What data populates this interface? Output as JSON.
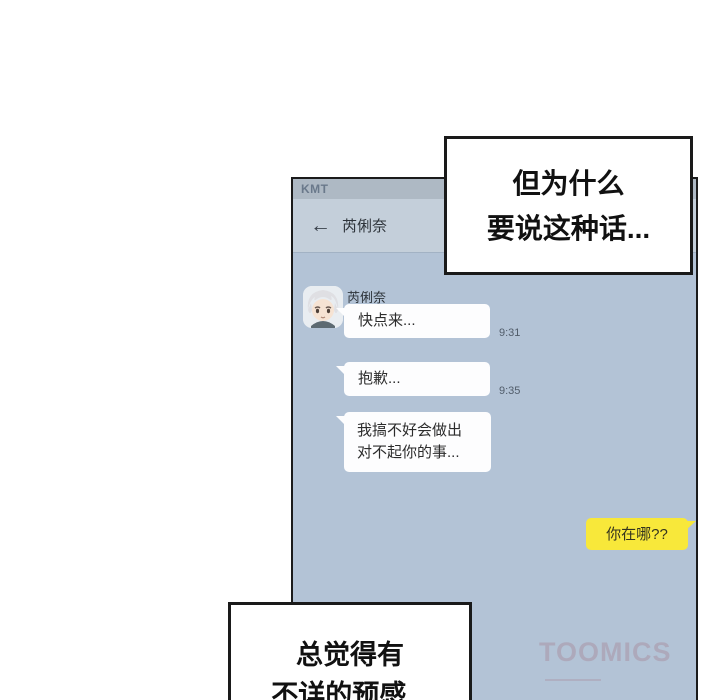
{
  "chat": {
    "status": {
      "carrier": "KMT"
    },
    "nav": {
      "back_arrow": "←",
      "title": "芮俐奈"
    },
    "sender": {
      "name": "芮俐奈"
    },
    "messages": [
      {
        "side": "left",
        "text": "快点来...",
        "time": "9:31"
      },
      {
        "side": "left",
        "text": "抱歉...",
        "time": "9:35"
      },
      {
        "side": "left",
        "line1": "我搞不好会做出",
        "line2": "对不起你的事..."
      },
      {
        "side": "right",
        "text": "你在哪??"
      }
    ],
    "watermark": "TOOMICS"
  },
  "speech_bubbles": {
    "top": {
      "line1": "但为什么",
      "line2": "要说这种话..."
    },
    "bottom": {
      "line1": "总觉得有",
      "line2": "不详的预感..."
    }
  },
  "colors": {
    "chat_background": "#b3c3d6",
    "status_bar": "#aeb9c4",
    "nav_bar": "#c4cfda",
    "bubble_white": "#fdfdfe",
    "bubble_yellow": "#f8e83a",
    "panel_border": "#1b1b1b",
    "speech_border": "#1a1a1a"
  }
}
